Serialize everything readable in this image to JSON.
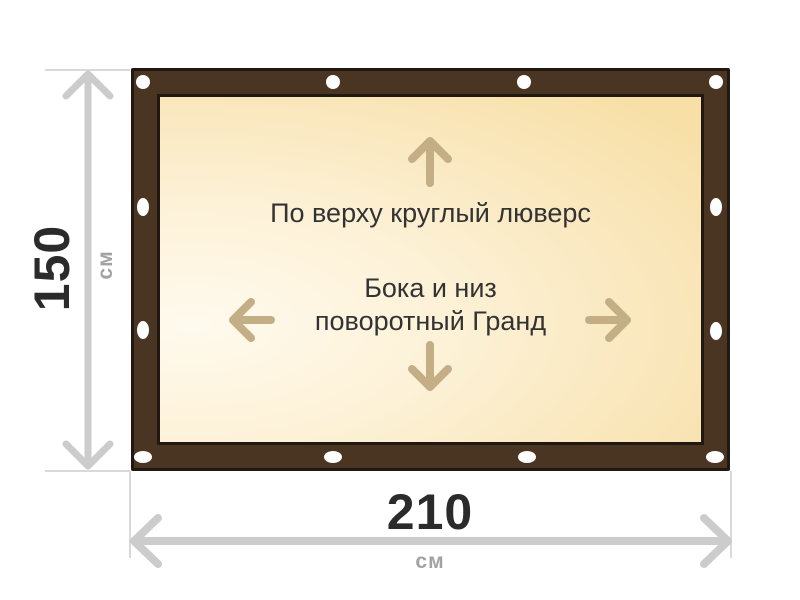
{
  "diagram": {
    "title": "banner-with-frame-and-grommets",
    "notes": {
      "top": "По верху круглый люверс",
      "mid1": "Бока и низ",
      "mid2": "поворотный Гранд"
    },
    "dims": {
      "height": {
        "value": "150",
        "unit": "см"
      },
      "width": {
        "value": "210",
        "unit": "см"
      }
    },
    "grommets": {
      "count": 12,
      "color": "#ffffff"
    },
    "icons": {
      "up": "arrow-up-icon",
      "down": "arrow-down-icon",
      "left": "arrow-left-icon",
      "right": "arrow-right-icon",
      "height_measure": "double-arrow-vertical-icon",
      "width_measure": "double-arrow-horizontal-icon"
    },
    "colors": {
      "frame_brown": "#4a3523",
      "frame_outline": "#211811",
      "canvas_light": "#fffaee",
      "canvas_dark": "#f7dfa6",
      "direction_arrow": "#c4ae86",
      "dimension_arrow": "#cccccc",
      "extension_line": "#d9d9d9",
      "dimension_value_text": "#2b2b2b",
      "dimension_unit_text": "#a2a2a2",
      "note_text": "#333333",
      "background": "#ffffff"
    }
  }
}
